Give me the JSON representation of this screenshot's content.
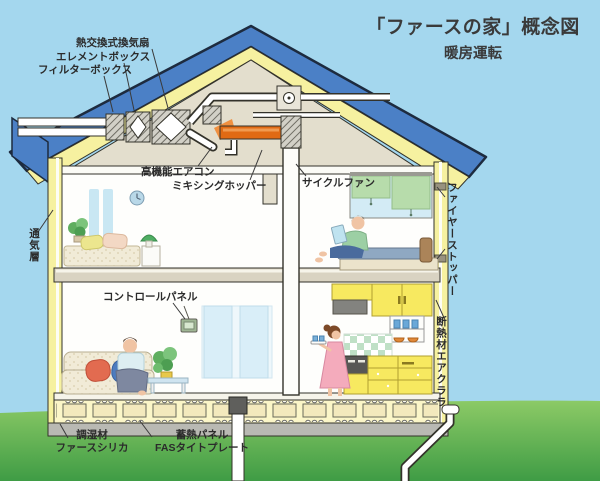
{
  "title": "「ファースの家」概念図",
  "subtitle": "暖房運転",
  "labels": {
    "heat_exchange_fan": "熱交換式換気扇",
    "element_box": "エレメントボックス",
    "filter_box": "フィルターボックス",
    "high_performance_aircon": "高機能エアコン",
    "mixing_hopper": "ミキシングホッパー",
    "cycle_fan": "サイクルファン",
    "fire_stopper": "ファイヤーストッパー",
    "insulation": "断熱材",
    "air_clara": "エアクララ",
    "ventilation_layer": "通気層",
    "control_panel": "コントロールパネル",
    "humidity_material": "調湿材",
    "fas_silica": "ファースシリカ",
    "heat_storage_panel": "蓄熱パネル",
    "fas_tight_plate": "FASタイトプレート"
  },
  "colors": {
    "sky": "#a4d7ee",
    "grass_top": "#8cca66",
    "grass_bottom": "#3f9c45",
    "roof_blue": "#4b80c6",
    "insulation_yellow": "#f6f1a0",
    "attic_beige": "#e3decd",
    "duct_orange": "#e06a14",
    "kitchen_yellow": "#f7e960",
    "label_text": "#2b2b2b"
  }
}
